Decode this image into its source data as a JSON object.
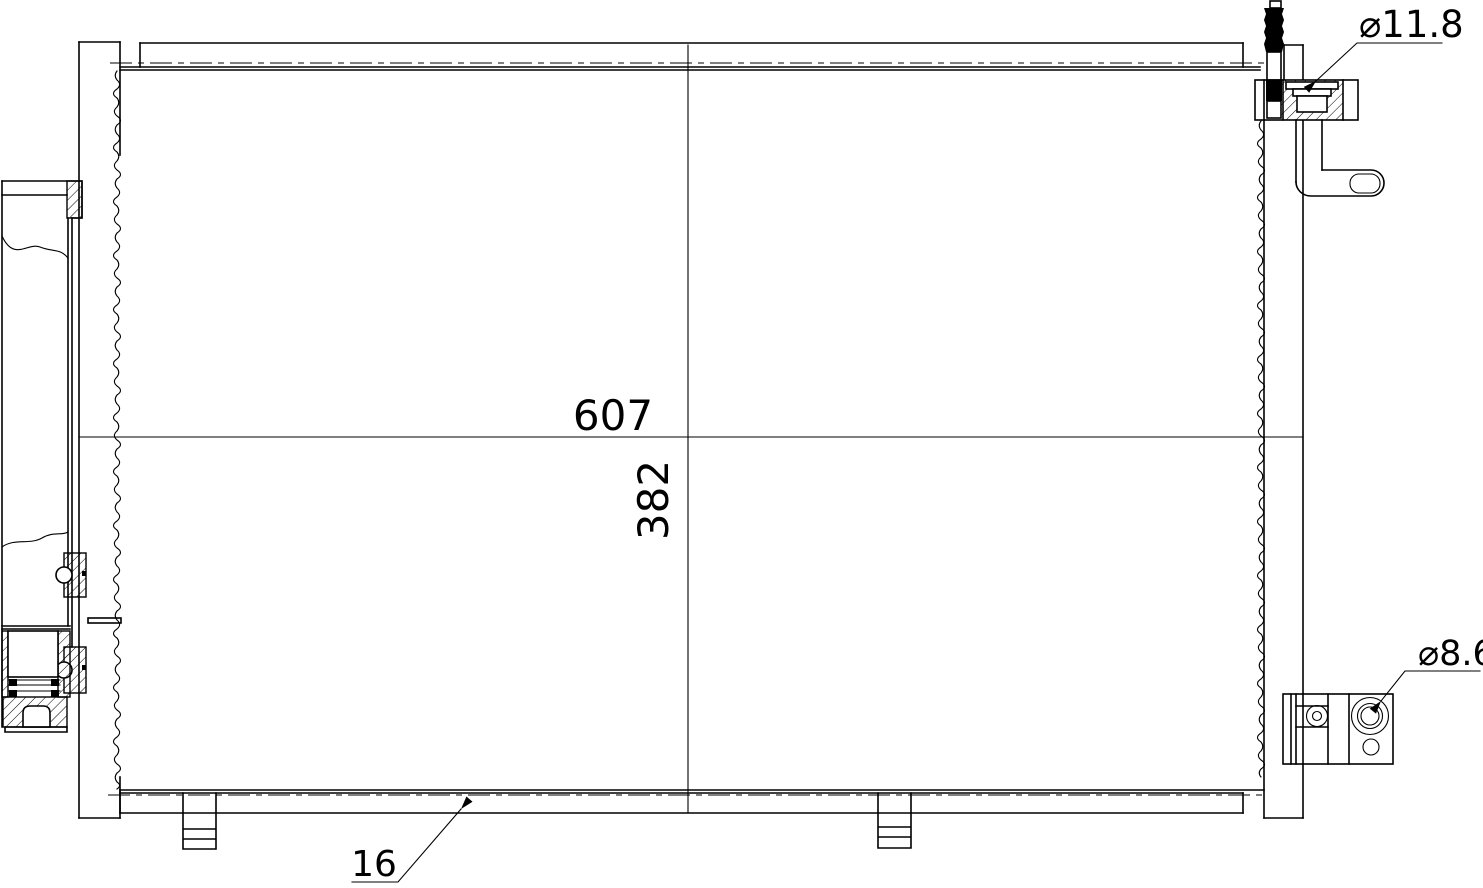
{
  "drawing": {
    "labels": {
      "core_width": "607",
      "core_height": "382",
      "inlet_diameter": "⌀11.8",
      "outlet_diameter": "⌀8.6",
      "core_thickness": "16"
    },
    "colors": {
      "line": "#000000",
      "background": "#ffffff"
    }
  }
}
